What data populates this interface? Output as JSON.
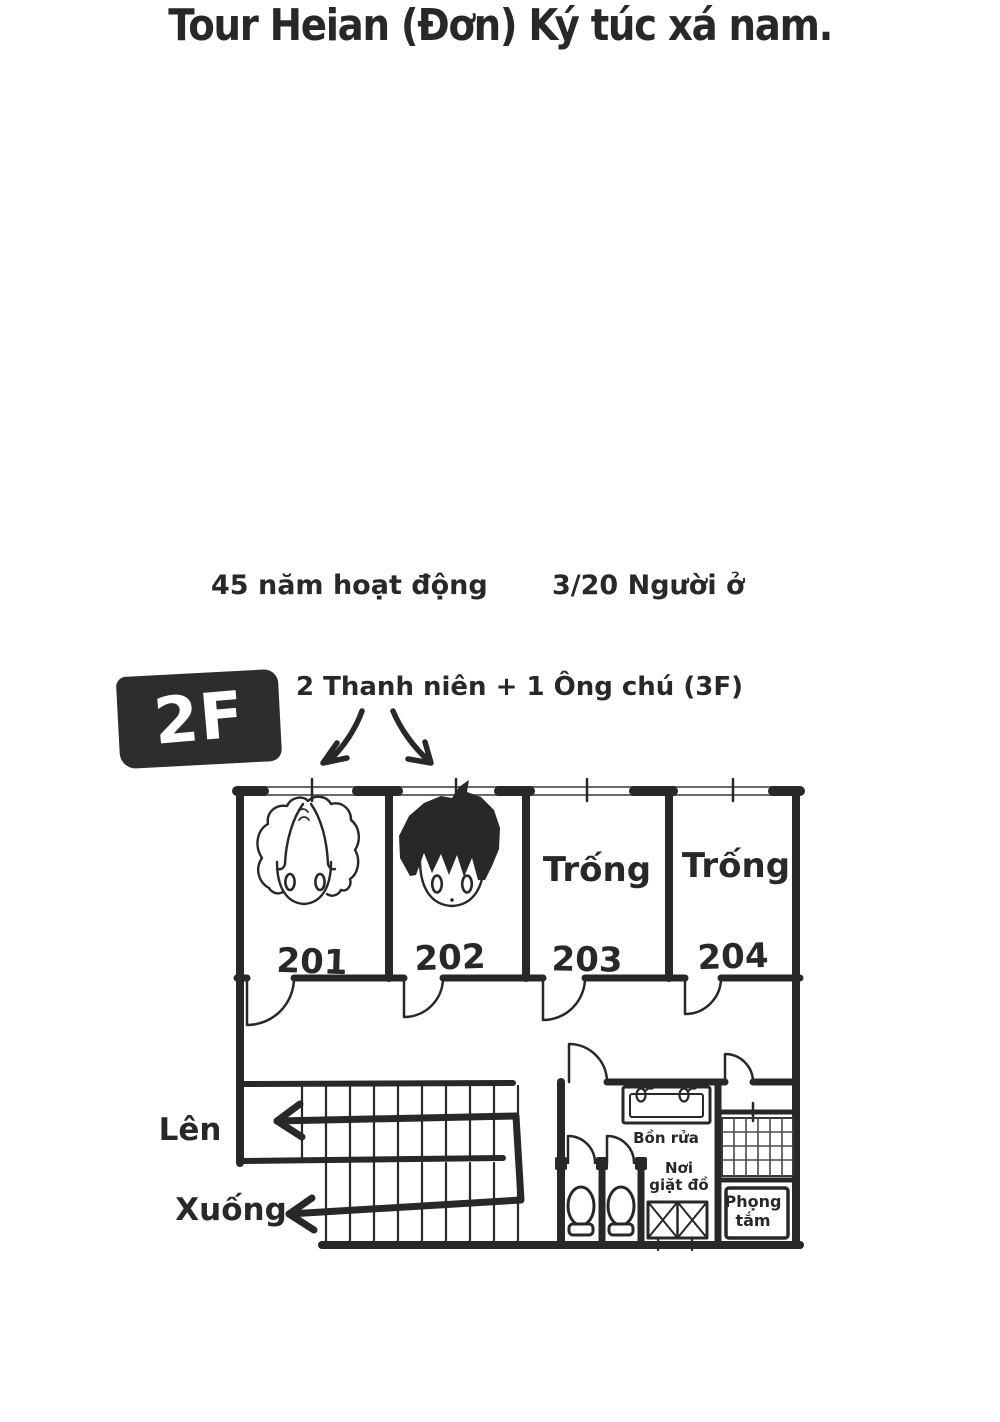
{
  "palette": {
    "ink": "#282828",
    "paper": "#ffffff",
    "badge_bg": "#2d2d2d",
    "badge_text": "#ffffff"
  },
  "header": {
    "title": "Tour Heian (Đơn) Ký túc xá nam.",
    "stat_left": "45 năm hoạt động",
    "stat_right": "3/20 Người ở"
  },
  "floor": {
    "badge_label": "2F",
    "note": "2 Thanh niên + 1 Ông chú (3F)"
  },
  "rooms": [
    {
      "number": "201",
      "status": "",
      "occupant_icon": "resident-light-hair"
    },
    {
      "number": "202",
      "status": "",
      "occupant_icon": "resident-dark-hair"
    },
    {
      "number": "203",
      "status": "Trống",
      "occupant_icon": ""
    },
    {
      "number": "204",
      "status": "Trống",
      "occupant_icon": ""
    }
  ],
  "stairs": {
    "up_label": "Lên",
    "down_label": "Xuống"
  },
  "facilities": {
    "sink_label": "Bồn rửa",
    "laundry_label_line1": "Nơi",
    "laundry_label_line2": "giặt đồ",
    "bath_label_line1": "Phọng",
    "bath_label_line2": "tắm"
  }
}
